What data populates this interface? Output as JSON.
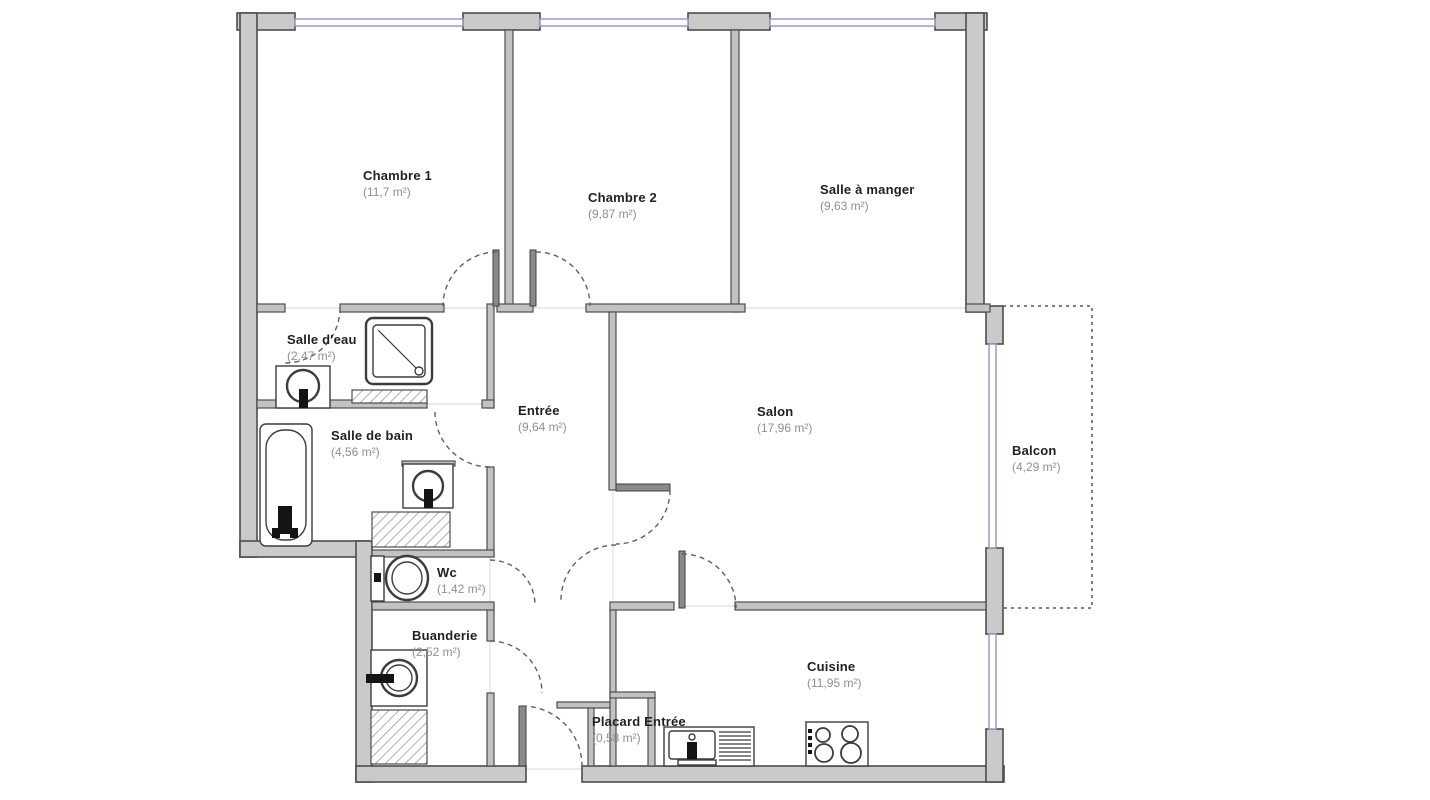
{
  "rooms": [
    {
      "id": "chambre-1",
      "name": "Chambre 1",
      "area": "(11,7 m²)"
    },
    {
      "id": "chambre-2",
      "name": "Chambre 2",
      "area": "(9,87 m²)"
    },
    {
      "id": "salle-a-manger",
      "name": "Salle à manger",
      "area": "(9,63 m²)"
    },
    {
      "id": "salle-d-eau",
      "name": "Salle d'eau",
      "area": "(2,47 m²)"
    },
    {
      "id": "salle-de-bain",
      "name": "Salle de bain",
      "area": "(4,56 m²)"
    },
    {
      "id": "entree",
      "name": "Entrée",
      "area": "(9,64 m²)"
    },
    {
      "id": "salon",
      "name": "Salon",
      "area": "(17,96 m²)"
    },
    {
      "id": "balcon",
      "name": "Balcon",
      "area": "(4,29 m²)"
    },
    {
      "id": "wc",
      "name": "Wc",
      "area": "(1,42 m²)"
    },
    {
      "id": "buanderie",
      "name": "Buanderie",
      "area": "(2,52 m²)"
    },
    {
      "id": "cuisine",
      "name": "Cuisine",
      "area": "(11,95 m²)"
    },
    {
      "id": "placard-entree",
      "name": "Placard Entrée",
      "area": "(0,58 m²)"
    }
  ],
  "colors": {
    "exterior_wall": "#cacaca",
    "interior_wall": "#c2c2c2",
    "wall_outline": "#4d4d4d",
    "window": "#9a9ac8",
    "door_arc": "#606060",
    "room_name_text": "#1f1f1f",
    "room_area_text": "#8f8f8f"
  }
}
